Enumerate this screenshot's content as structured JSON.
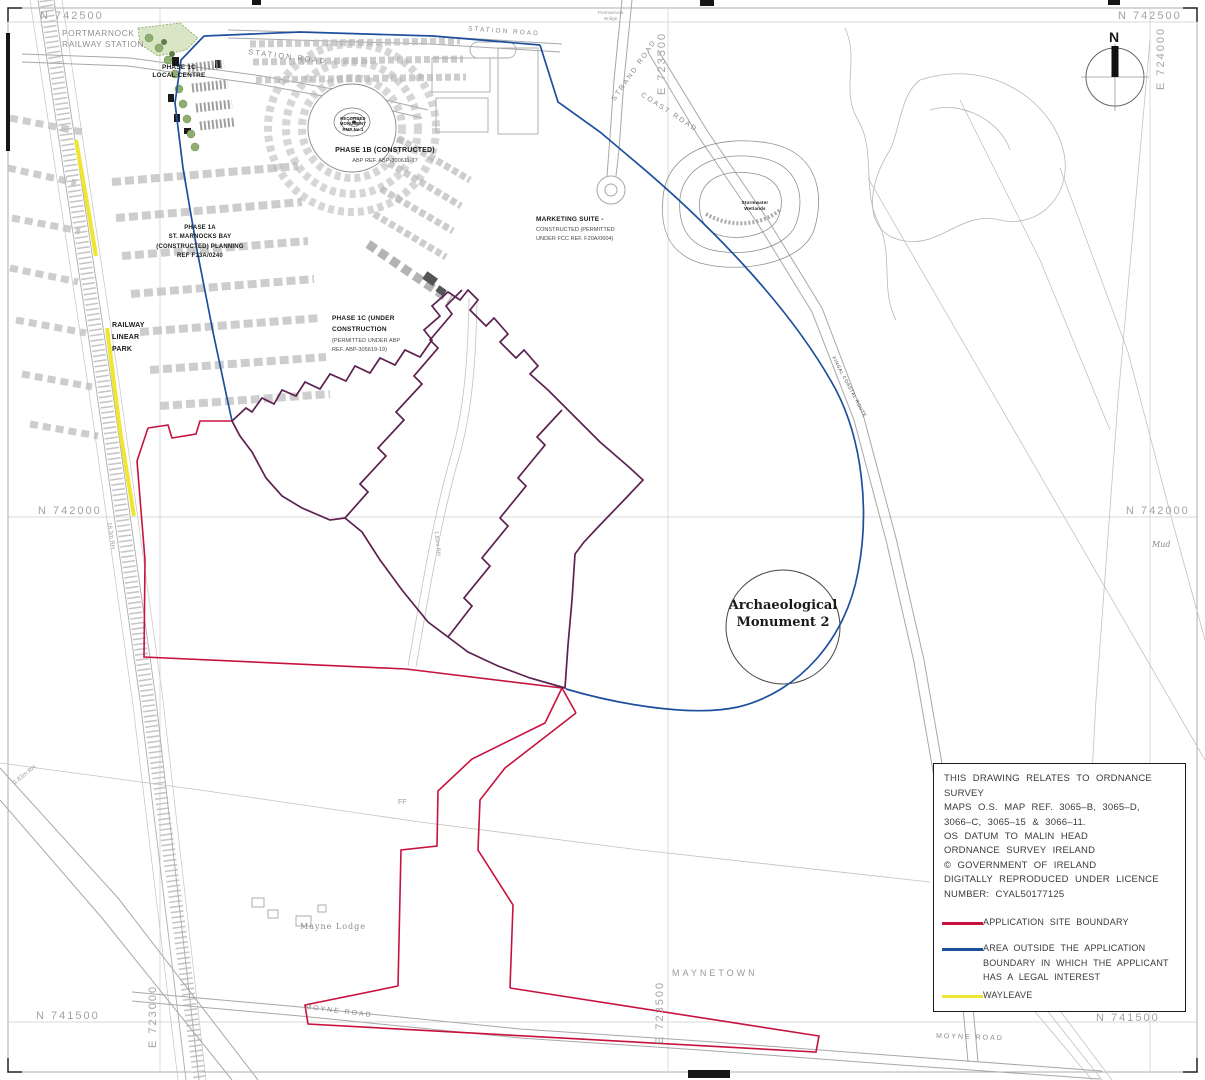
{
  "colors": {
    "boundary_red": "#c8123e",
    "legal_interest_blue": "#1d4f9e",
    "wayleave_yellow": "#f0e532",
    "overlap_purple": "#5c2150"
  },
  "grid": {
    "n742500": "N 742500",
    "n742000": "N 742000",
    "n741500": "N 741500",
    "e723000": "E 723000",
    "e723500": "E 723500",
    "e724000": "E 724000"
  },
  "roads": {
    "station": "STATION ROAD",
    "strand": "STRAND ROAD",
    "coast": "COAST ROAD",
    "moyne": "MOYNE ROAD",
    "fingal_coastal_route": "FINGAL COASTAL ROUTE"
  },
  "labels": {
    "railway_station": "PORTMARNOCK\nRAILWAY STATION",
    "local_centre": "PHASE 1C\nLOCAL CENTRE",
    "recorded_monument": "RECORDED\nMONUMENT\nRMP No.1",
    "phase_1b_title": "PHASE 1B (CONSTRUCTED)",
    "phase_1b_ref": "ABP REF. ABP-300611-17",
    "phase_1a": "PHASE 1A\nST. MARNOCKS BAY\n(CONSTRUCTED)  PLANNING\nREF F13A/0240",
    "railway_linear_park": "RAILWAY\nLINEAR\nPARK",
    "phase_1c_title": "PHASE 1C (UNDER\nCONSTRUCTION",
    "phase_1c_ref": "(PERMITTED UNDER ABP\nREF. ABP-305619-19)",
    "marketing_suite_title": "MARKETING SUITE -",
    "marketing_suite_ref": "CONSTRUCTED (PERMITTED\nUNDER FCC REF. F20A/0604)",
    "arch_monument_2": "Archaeological\nMonument 2",
    "mayne_lodge": "Mayne Lodge",
    "maynetown": "MAYNETOWN",
    "mud": "Mud",
    "bridge": "Portmarnock\nBridge",
    "wetland": "Stormwater\nWetlands",
    "hedge_1": "1.83m RH",
    "hedge_2": "18.3m RH",
    "ff": "FF"
  },
  "compass": {
    "north": "N"
  },
  "notes": {
    "survey_note": "THIS DRAWING RELATES TO ORDNANCE SURVEY\nMAPS O.S. MAP REF. 3065–B, 3065–D,\n3066–C, 3065–15 & 3066–11.\nOS DATUM TO MALIN HEAD",
    "licence_note": "ORDNANCE SURVEY IRELAND\n© GOVERNMENT OF IRELAND\nDIGITALLY REPRODUCED UNDER LICENCE\nNUMBER: CYAL50177125"
  },
  "legend": {
    "items": [
      {
        "label": "APPLICATION SITE BOUNDARY",
        "color": "#c8123e"
      },
      {
        "label": "AREA OUTSIDE THE APPLICATION\nBOUNDARY IN WHICH THE APPLICANT\nHAS A LEGAL INTEREST",
        "color": "#1d4f9e"
      },
      {
        "label": "WAYLEAVE",
        "color": "#f0e532"
      }
    ]
  }
}
